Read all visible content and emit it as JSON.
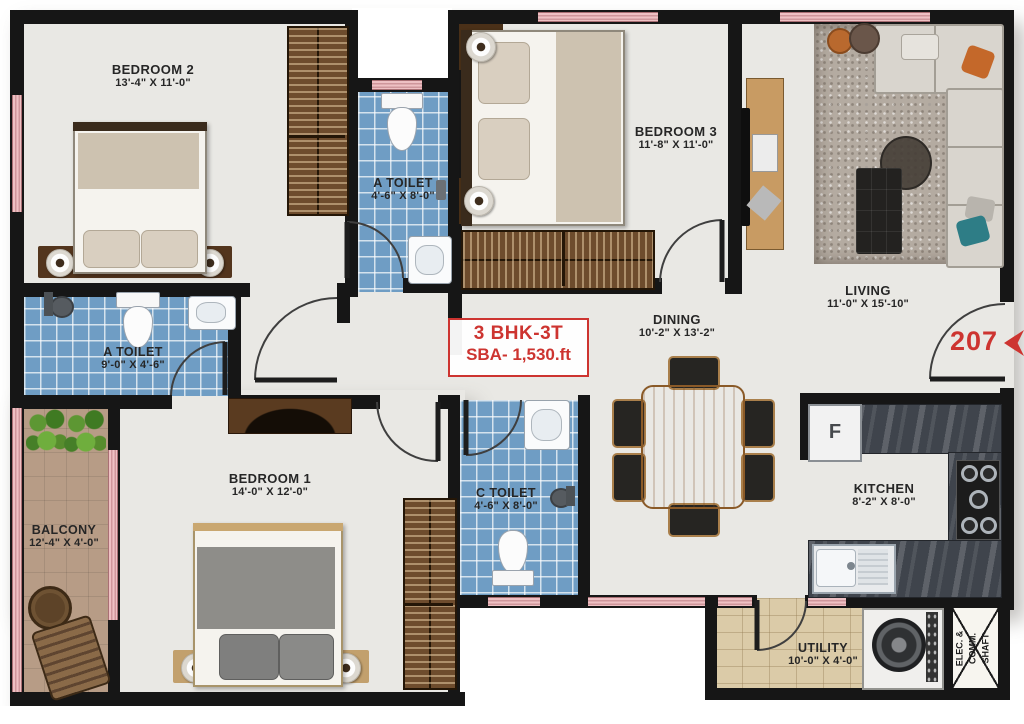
{
  "unit": {
    "type_label": "3 BHK-3T",
    "area_label": "SBA- 1,530.ft",
    "door_number": "207"
  },
  "rooms": {
    "bedroom2": {
      "name": "BEDROOM 2",
      "dims": "13'-4\" X 11'-0\""
    },
    "bedroom3": {
      "name": "BEDROOM 3",
      "dims": "11'-8\" X 11'-0\""
    },
    "bedroom1": {
      "name": "BEDROOM 1",
      "dims": "14'-0\" X 12'-0\""
    },
    "living": {
      "name": "LIVING",
      "dims": "11'-0\" X 15'-10\""
    },
    "dining": {
      "name": "DINING",
      "dims": "10'-2\" X 13'-2\""
    },
    "kitchen": {
      "name": "KITCHEN",
      "dims": "8'-2\" X 8'-0\""
    },
    "toilet_a_top": {
      "name": "A TOILET",
      "dims": "4'-6\" X 8'-0\""
    },
    "toilet_a_left": {
      "name": "A TOILET",
      "dims": "9'-0\" X 4'-6\""
    },
    "toilet_c": {
      "name": "C TOILET",
      "dims": "4'-6\" X 8'-0\""
    },
    "balcony": {
      "name": "BALCONY",
      "dims": "12'-4\" X 4'-0\""
    },
    "utility": {
      "name": "UTILITY",
      "dims": "10'-0\" X 4'-0\""
    }
  },
  "shaft": {
    "line1": "ELEC. &",
    "line2": "COMM.",
    "line3": "SHAFT"
  },
  "appliances": {
    "fridge_label": "F"
  },
  "colors": {
    "wall": "#161616",
    "tile_blue": "#6f9dc4",
    "window_pink": "#eec0c3",
    "accent_red": "#cd3430",
    "floor_gray": "#e9e8e4",
    "balcony_floor": "#b79c86",
    "utility_floor": "#dbcba8",
    "wardrobe_wood": "#6e4c2d",
    "dining_wood": "#c08a4f"
  }
}
